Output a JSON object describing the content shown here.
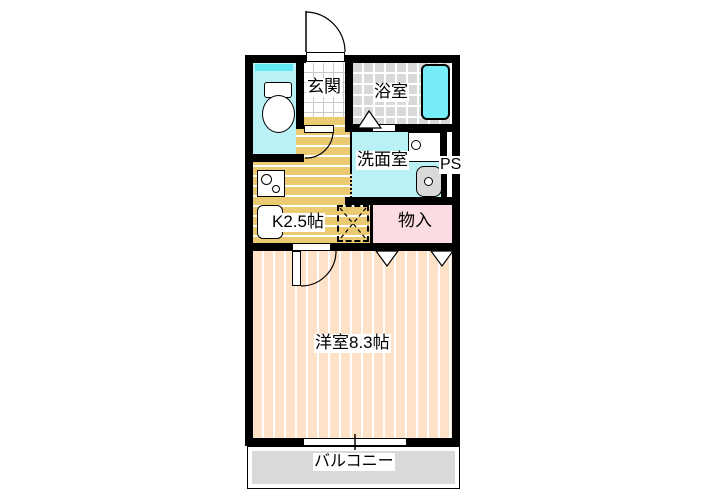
{
  "plan": {
    "type": "apartment-floor-plan",
    "rooms": {
      "genkan": {
        "label": "玄関"
      },
      "bathroom": {
        "label": "浴室"
      },
      "washroom": {
        "label": "洗面室"
      },
      "ps": {
        "label": "PS"
      },
      "kitchen": {
        "label": "K2.5帖"
      },
      "closet": {
        "label": "物入"
      },
      "main_room": {
        "label": "洋室8.3帖"
      },
      "balcony": {
        "label": "バルコニー"
      }
    },
    "colors": {
      "wall": "#000000",
      "water_room_floor": "#b9f1f5",
      "toilet_window": "#62e8f2",
      "bathtub": "#76ecf7",
      "bathroom_tile": "#d9d9d9",
      "kitchen_floor": "#ecca72",
      "room_floor": "#fde2c8",
      "closet_floor": "#fbdce2",
      "balcony_floor": "#d9d9d9",
      "fixture_gray": "#d9d9d9"
    },
    "fixtures": [
      "toilet",
      "bathtub",
      "stove",
      "kitchen-sink",
      "washing-machine-pan",
      "washbasin",
      "refrigerator-space"
    ]
  }
}
